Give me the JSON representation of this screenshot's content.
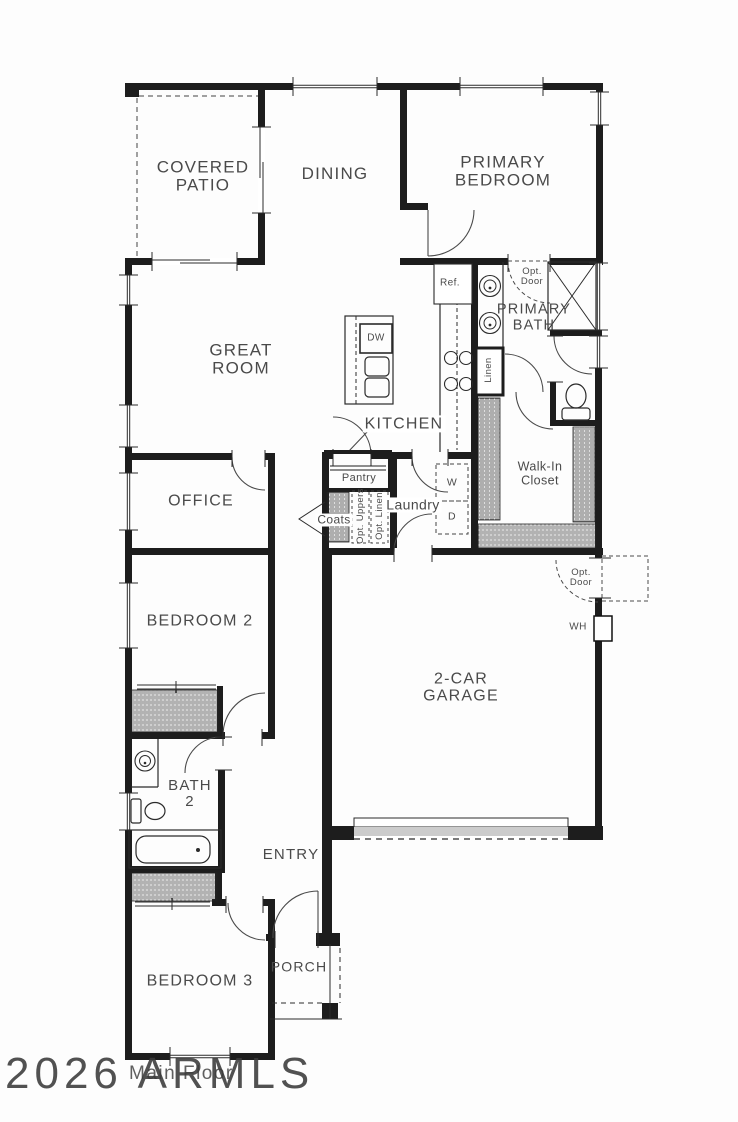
{
  "watermark": {
    "text": "2026 ARMLS"
  },
  "floor": {
    "label": "Main Floor"
  },
  "rooms": {
    "covered_patio": "COVERED\nPATIO",
    "dining": "DINING",
    "primary_bedroom": "PRIMARY\nBEDROOM",
    "great_room": "GREAT\nROOM",
    "primary_bath": "PRIMARY\nBATH",
    "kitchen": "KITCHEN",
    "walk_in_closet": "Walk-In\nCloset",
    "office": "OFFICE",
    "laundry": "Laundry",
    "bedroom_2": "BEDROOM 2",
    "garage": "2-CAR\nGARAGE",
    "bath_2": "BATH\n2",
    "entry": "ENTRY",
    "bedroom_3": "BEDROOM 3",
    "porch": "PORCH"
  },
  "features": {
    "pantry": "Pantry",
    "coats": "Coats",
    "opt_uppers": "Opt. Uppers",
    "opt_linen": "Opt. Linen",
    "linen": "Linen",
    "ref": "Ref.",
    "dw": "DW",
    "washer": "W",
    "dryer": "D",
    "water_heater": "WH",
    "opt_door": "Opt.\nDoor"
  },
  "colors": {
    "wall": "#1d1d1d",
    "label": "#4a4a4a",
    "thin_line": "#2b2b2b",
    "garage_apron": "#cccccc",
    "watermark": "#3a3a3a"
  }
}
